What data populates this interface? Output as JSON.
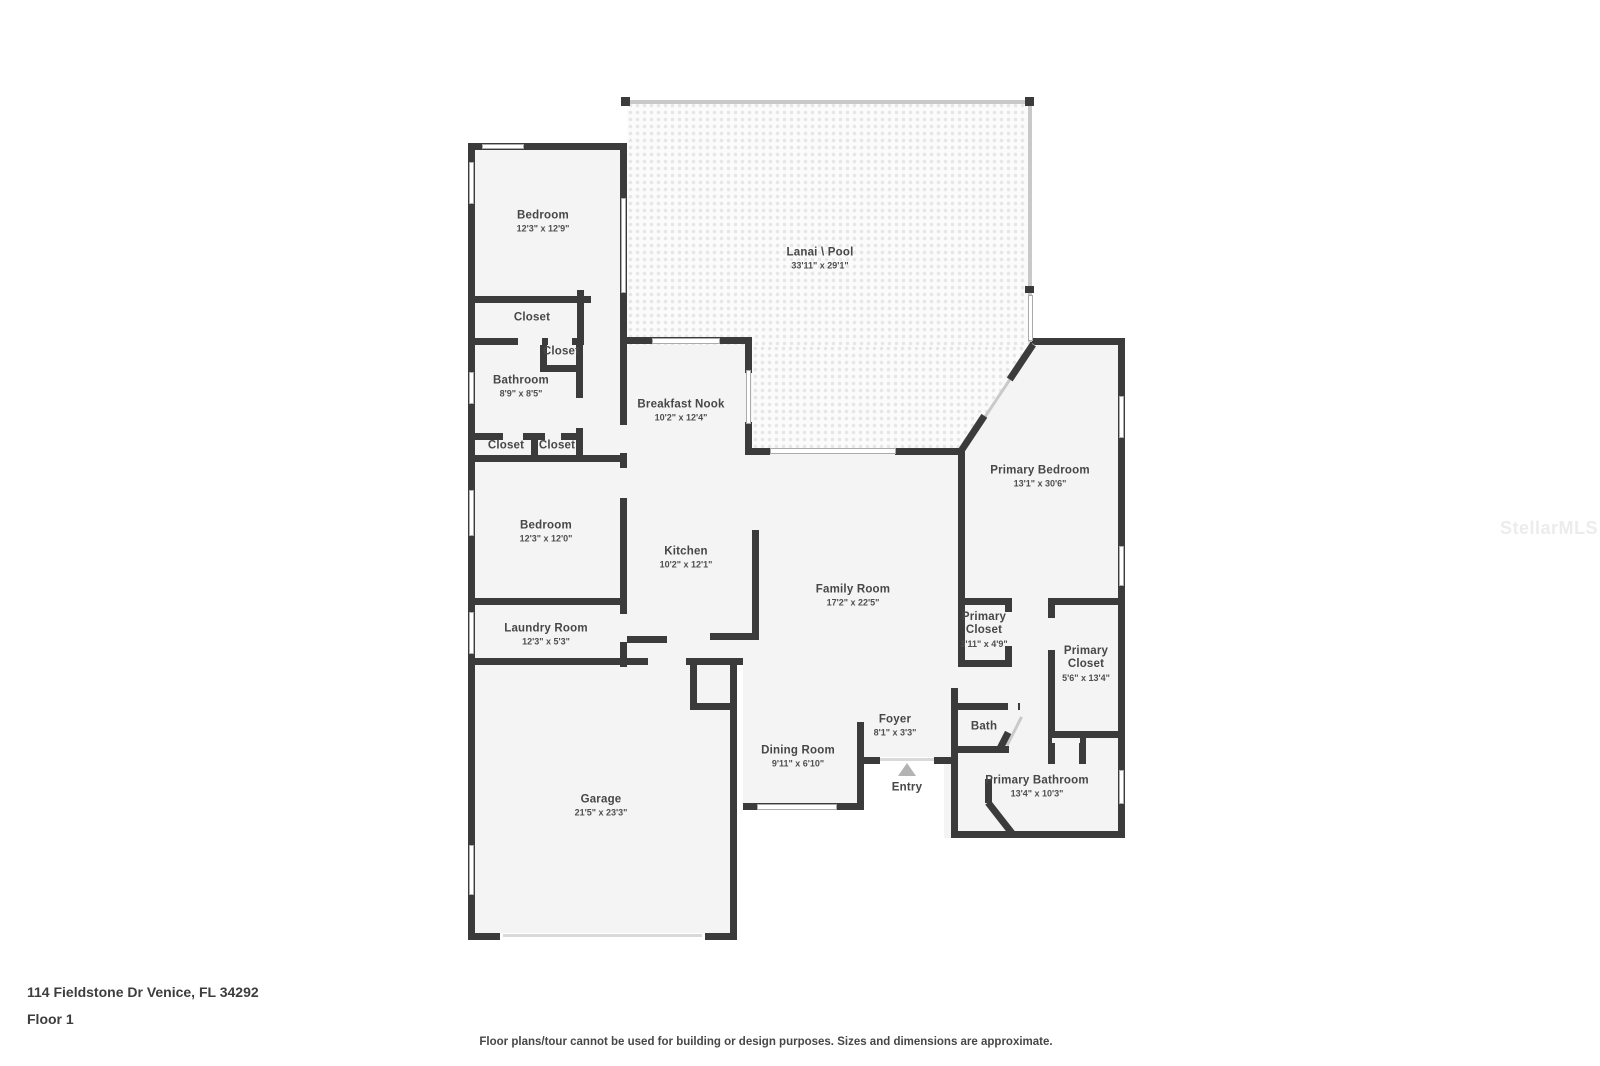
{
  "meta": {
    "address": "114 Fieldstone Dr Venice, FL 34292",
    "floor_label": "Floor 1",
    "disclaimer": "Floor plans/tour cannot be used for building or design purposes. Sizes and dimensions are approximate.",
    "watermark": "StellarMLS"
  },
  "colors": {
    "wall": "#3b3b3b",
    "floor": "#f4f4f4",
    "screen": "#c9c9c9",
    "window_border": "#ababab",
    "door_gap": "#f4f4f4",
    "threshold": "#d9d9d9",
    "entry_marker": "#b3b3b3",
    "label_text": "#474747",
    "watermark_text": "#ececec"
  },
  "rooms": {
    "bedroom1": {
      "name": "Bedroom",
      "dims": "12'3\" x 12'9\""
    },
    "lanai": {
      "name": "Lanai \\ Pool",
      "dims": "33'11\" x 29'1\""
    },
    "closet1": {
      "name": "Closet",
      "dims": ""
    },
    "closet2": {
      "name": "Closet",
      "dims": ""
    },
    "bathroom": {
      "name": "Bathroom",
      "dims": "8'9\" x 8'5\""
    },
    "closet3": {
      "name": "Closet",
      "dims": ""
    },
    "closet4": {
      "name": "Closet",
      "dims": ""
    },
    "breakfast_nook": {
      "name": "Breakfast Nook",
      "dims": "10'2\" x 12'4\""
    },
    "primary_bedroom": {
      "name": "Primary Bedroom",
      "dims": "13'1\" x 30'6\""
    },
    "bedroom2": {
      "name": "Bedroom",
      "dims": "12'3\" x 12'0\""
    },
    "kitchen": {
      "name": "Kitchen",
      "dims": "10'2\" x 12'1\""
    },
    "family_room": {
      "name": "Family Room",
      "dims": "17'2\" x 22'5\""
    },
    "primary_closet_small": {
      "name": "Primary Closet",
      "dims": "3'11\" x 4'9\""
    },
    "laundry_room": {
      "name": "Laundry Room",
      "dims": "12'3\" x 5'3\""
    },
    "primary_closet_large": {
      "name": "Primary Closet",
      "dims": "5'6\" x 13'4\""
    },
    "foyer": {
      "name": "Foyer",
      "dims": "8'1\" x 3'3\""
    },
    "bath": {
      "name": "Bath",
      "dims": ""
    },
    "dining_room": {
      "name": "Dining Room",
      "dims": "9'11\" x 6'10\""
    },
    "entry": {
      "name": "Entry",
      "dims": ""
    },
    "garage": {
      "name": "Garage",
      "dims": "21'5\" x 23'3\""
    },
    "primary_bathroom": {
      "name": "Primary Bathroom",
      "dims": "13'4\" x 10'3\""
    }
  }
}
